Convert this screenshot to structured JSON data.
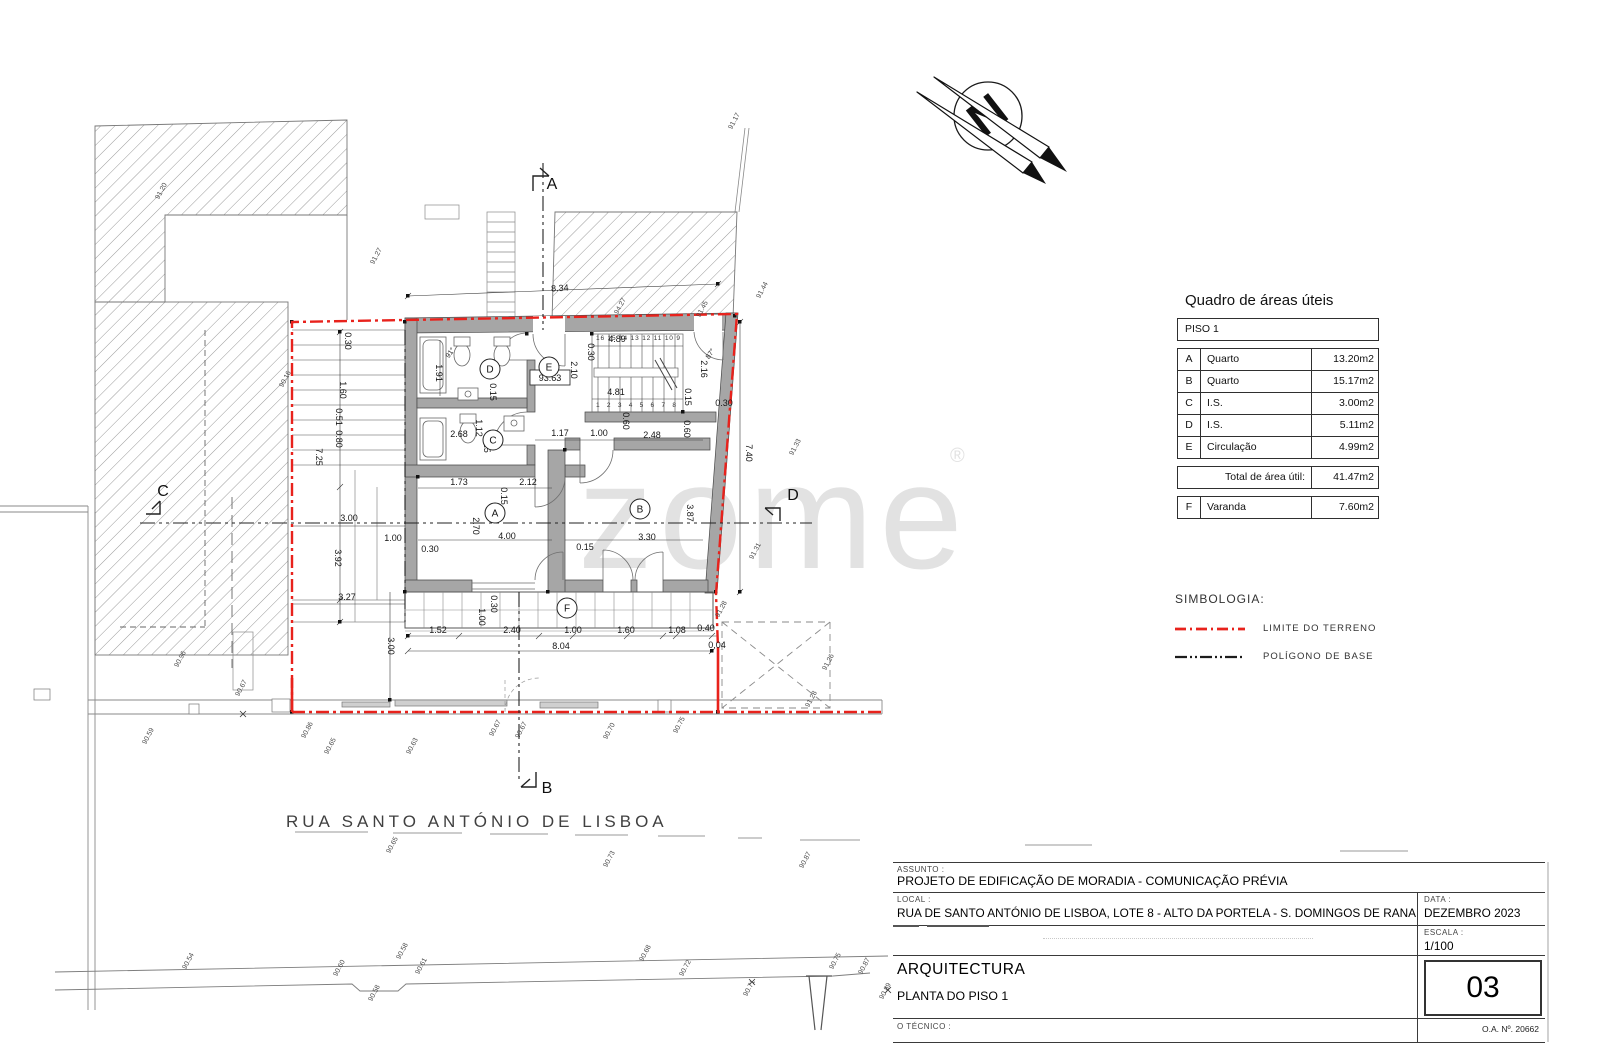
{
  "watermark": {
    "text": "zome",
    "reg": "®"
  },
  "north_arrow": {
    "letter": "N"
  },
  "plan": {
    "street_label": "RUA SANTO ANTÓNIO DE LISBOA",
    "level_tag": {
      "text": "93.63"
    },
    "stairs": {
      "top": "16 15 14 13 12 11 10 9",
      "bottom": "1 2 3 4 5 6 7 8"
    },
    "rooms": [
      {
        "id": "A",
        "x": 495,
        "y": 513
      },
      {
        "id": "B",
        "x": 640,
        "y": 509
      },
      {
        "id": "C",
        "x": 493,
        "y": 440
      },
      {
        "id": "D",
        "x": 490,
        "y": 369
      },
      {
        "id": "E",
        "x": 549,
        "y": 367
      },
      {
        "id": "F",
        "x": 567,
        "y": 608
      }
    ],
    "section_markers": [
      {
        "id": "A",
        "x": 552,
        "y": 189
      },
      {
        "id": "B",
        "x": 547,
        "y": 793
      },
      {
        "id": "C",
        "x": 163,
        "y": 496
      },
      {
        "id": "D",
        "x": 793,
        "y": 500
      }
    ],
    "dimensions": [
      {
        "t": "8.34",
        "x": 560,
        "y": 291,
        "r": -3
      },
      {
        "t": "0.30",
        "x": 588,
        "y": 352,
        "r": 90
      },
      {
        "t": "4.89",
        "x": 617,
        "y": 342
      },
      {
        "t": "2.10",
        "x": 571,
        "y": 370,
        "r": 90
      },
      {
        "t": "1.91",
        "x": 436,
        "y": 373,
        "r": 90
      },
      {
        "t": "0.15",
        "x": 490,
        "y": 392,
        "r": 90
      },
      {
        "t": "4.81",
        "x": 616,
        "y": 395
      },
      {
        "t": "2.16",
        "x": 701,
        "y": 369,
        "r": 90
      },
      {
        "t": "0.15",
        "x": 685,
        "y": 397,
        "r": 90
      },
      {
        "t": "0.30",
        "x": 724,
        "y": 406
      },
      {
        "t": "2.68",
        "x": 459,
        "y": 437
      },
      {
        "t": "1.12",
        "x": 476,
        "y": 428,
        "r": 90
      },
      {
        "t": "0.15",
        "x": 484,
        "y": 444,
        "r": 90
      },
      {
        "t": "1.17",
        "x": 560,
        "y": 436
      },
      {
        "t": "1.00",
        "x": 599,
        "y": 436
      },
      {
        "t": "2.48",
        "x": 652,
        "y": 438
      },
      {
        "t": "0.60",
        "x": 623,
        "y": 421,
        "r": 90
      },
      {
        "t": "0.60",
        "x": 684,
        "y": 429,
        "r": 90
      },
      {
        "t": "1.73",
        "x": 459,
        "y": 485
      },
      {
        "t": "0.15",
        "x": 501,
        "y": 496,
        "r": 90
      },
      {
        "t": "2.12",
        "x": 528,
        "y": 485
      },
      {
        "t": "2.70",
        "x": 473,
        "y": 526,
        "r": 90
      },
      {
        "t": "4.00",
        "x": 507,
        "y": 539
      },
      {
        "t": "0.30",
        "x": 430,
        "y": 552
      },
      {
        "t": "0.15",
        "x": 585,
        "y": 550
      },
      {
        "t": "3.30",
        "x": 647,
        "y": 540
      },
      {
        "t": "3.87",
        "x": 687,
        "y": 513,
        "r": 90
      },
      {
        "t": "0.30",
        "x": 491,
        "y": 604,
        "r": 90
      },
      {
        "t": "1.00",
        "x": 479,
        "y": 617,
        "r": 90
      },
      {
        "t": "1.52",
        "x": 438,
        "y": 633
      },
      {
        "t": "2.40",
        "x": 512,
        "y": 633
      },
      {
        "t": "1.00",
        "x": 573,
        "y": 633
      },
      {
        "t": "1.60",
        "x": 626,
        "y": 633
      },
      {
        "t": "1.08",
        "x": 677,
        "y": 633
      },
      {
        "t": "0.40",
        "x": 706,
        "y": 631
      },
      {
        "t": "0.04",
        "x": 717,
        "y": 648
      },
      {
        "t": "8.04",
        "x": 561,
        "y": 649
      },
      {
        "t": "3.00",
        "x": 388,
        "y": 646,
        "r": 90
      },
      {
        "t": "7.40",
        "x": 746,
        "y": 453,
        "r": 90
      },
      {
        "t": "0.30",
        "x": 345,
        "y": 341,
        "r": 90
      },
      {
        "t": "1.60",
        "x": 340,
        "y": 390,
        "r": 90
      },
      {
        "t": "0.51",
        "x": 336,
        "y": 417,
        "r": 90
      },
      {
        "t": "0.80",
        "x": 336,
        "y": 439,
        "r": 90
      },
      {
        "t": "7.25",
        "x": 316,
        "y": 457,
        "r": 90
      },
      {
        "t": "3.00",
        "x": 349,
        "y": 521
      },
      {
        "t": "3.92",
        "x": 335,
        "y": 558,
        "r": 90
      },
      {
        "t": "1.00",
        "x": 393,
        "y": 541
      },
      {
        "t": "3.27",
        "x": 347,
        "y": 600
      },
      {
        "t": "91°",
        "x": 452,
        "y": 354,
        "r": -55,
        "s": 7
      },
      {
        "t": "87°",
        "x": 712,
        "y": 355,
        "r": -55,
        "s": 7
      }
    ],
    "elevations": [
      {
        "t": "91.20",
        "x": 163,
        "y": 192
      },
      {
        "t": "91.27",
        "x": 378,
        "y": 257
      },
      {
        "t": "94.27",
        "x": 622,
        "y": 307
      },
      {
        "t": "91.17",
        "x": 736,
        "y": 122
      },
      {
        "t": "91.44",
        "x": 764,
        "y": 291
      },
      {
        "t": "91.45",
        "x": 704,
        "y": 310
      },
      {
        "t": "90.16",
        "x": 287,
        "y": 380
      },
      {
        "t": "91.33",
        "x": 797,
        "y": 448
      },
      {
        "t": "91.31",
        "x": 757,
        "y": 552
      },
      {
        "t": "91.28",
        "x": 723,
        "y": 610
      },
      {
        "t": "91.26",
        "x": 830,
        "y": 663
      },
      {
        "t": "91.28",
        "x": 813,
        "y": 700
      },
      {
        "t": "90.96",
        "x": 182,
        "y": 660
      },
      {
        "t": "90.67",
        "x": 243,
        "y": 689
      },
      {
        "t": "90.59",
        "x": 150,
        "y": 737
      },
      {
        "t": "90.86",
        "x": 309,
        "y": 731
      },
      {
        "t": "90.65",
        "x": 332,
        "y": 747
      },
      {
        "t": "90.63",
        "x": 414,
        "y": 747
      },
      {
        "t": "90.67",
        "x": 497,
        "y": 729
      },
      {
        "t": "90.67",
        "x": 523,
        "y": 731
      },
      {
        "t": "90.70",
        "x": 611,
        "y": 732
      },
      {
        "t": "90.75",
        "x": 681,
        "y": 726
      },
      {
        "t": "90.65",
        "x": 394,
        "y": 846
      },
      {
        "t": "90.73",
        "x": 611,
        "y": 860
      },
      {
        "t": "90.87",
        "x": 807,
        "y": 861
      },
      {
        "t": "90.54",
        "x": 190,
        "y": 962
      },
      {
        "t": "90.60",
        "x": 341,
        "y": 969
      },
      {
        "t": "90.58",
        "x": 376,
        "y": 994
      },
      {
        "t": "90.58",
        "x": 404,
        "y": 952
      },
      {
        "t": "90.61",
        "x": 423,
        "y": 967
      },
      {
        "t": "90.68",
        "x": 647,
        "y": 954
      },
      {
        "t": "90.72",
        "x": 687,
        "y": 969
      },
      {
        "t": "90.71",
        "x": 751,
        "y": 989
      },
      {
        "t": "90.75",
        "x": 837,
        "y": 962
      },
      {
        "t": "90.87",
        "x": 866,
        "y": 967
      },
      {
        "t": "90.89",
        "x": 887,
        "y": 992
      }
    ]
  },
  "areas_table": {
    "title": "Quadro de áreas úteis",
    "group_header": "PISO 1",
    "rows": [
      {
        "letter": "A",
        "name": "Quarto",
        "area": "13.20m2"
      },
      {
        "letter": "B",
        "name": "Quarto",
        "area": "15.17m2"
      },
      {
        "letter": "C",
        "name": "I.S.",
        "area": "3.00m2"
      },
      {
        "letter": "D",
        "name": "I.S.",
        "area": "5.11m2"
      },
      {
        "letter": "E",
        "name": "Circulação",
        "area": "4.99m2"
      }
    ],
    "total": {
      "label": "Total de área útil:",
      "value": "41.47m2"
    },
    "extra": [
      {
        "letter": "F",
        "name": "Varanda",
        "area": "7.60m2"
      }
    ]
  },
  "legend": {
    "title": "SIMBOLOGIA:",
    "items": [
      {
        "label": "LIMITE  DO  TERRENO",
        "color": "#e8221c"
      },
      {
        "label": "POLÍGONO  DE  BASE",
        "color": "#1c1c1c"
      }
    ]
  },
  "title_block": {
    "assunto_label": "ASSUNTO :",
    "assunto": "PROJETO DE EDIFICAÇÃO DE MORADIA  -  COMUNICAÇÃO PRÉVIA",
    "local_label": "LOCAL :",
    "local": "RUA DE SANTO ANTÓNIO DE LISBOA, LOTE 8 - ALTO DA PORTELA - S. DOMINGOS DE RANA",
    "data_label": "DATA :",
    "data": "DEZEMBRO 2023",
    "escala_label": "ESCALA :",
    "escala": "1/100",
    "discipline": "ARQUITECTURA",
    "drawing_title": "PLANTA DO PISO 1",
    "tecnico_label": "O TÉCNICO :",
    "oa_number": "O.A.  Nº. 20662",
    "sheet_number": "03"
  }
}
